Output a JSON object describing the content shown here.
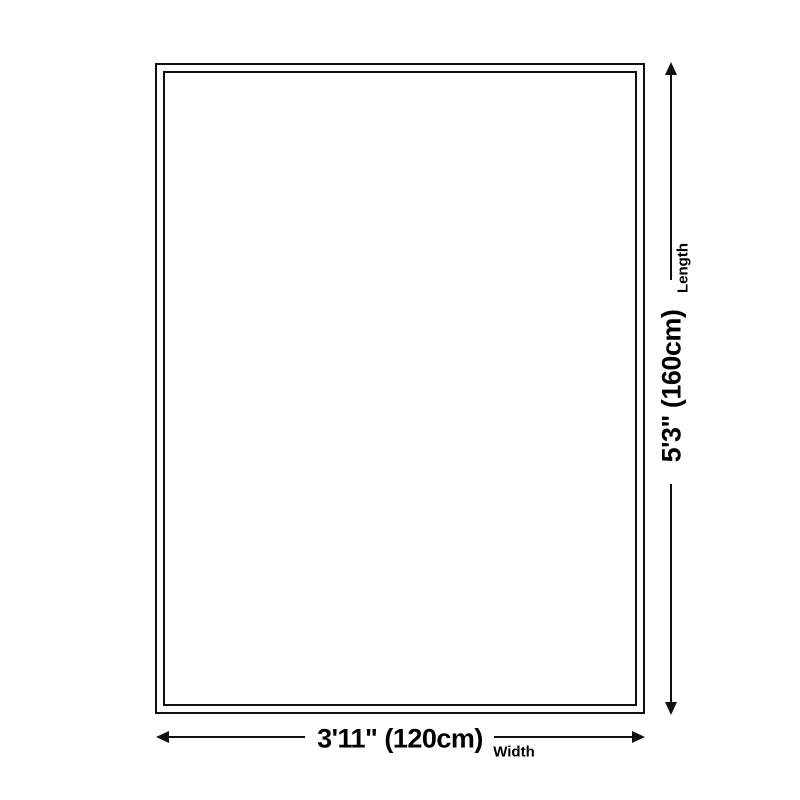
{
  "diagram": {
    "type": "product-dimension-diagram",
    "shape": "rectangle",
    "dimensions": {
      "length": {
        "value": "5'3\" (160cm)",
        "label": "Length",
        "orientation": "vertical"
      },
      "width": {
        "value": "3'11\" (120cm)",
        "label": "Width",
        "orientation": "horizontal"
      }
    },
    "icons": {
      "vertical_arrow": "double-headed-arrow-vertical",
      "horizontal_arrow": "double-headed-arrow-horizontal"
    },
    "colors": {
      "line": "#111111",
      "text": "#000000",
      "background": "#ffffff"
    }
  }
}
